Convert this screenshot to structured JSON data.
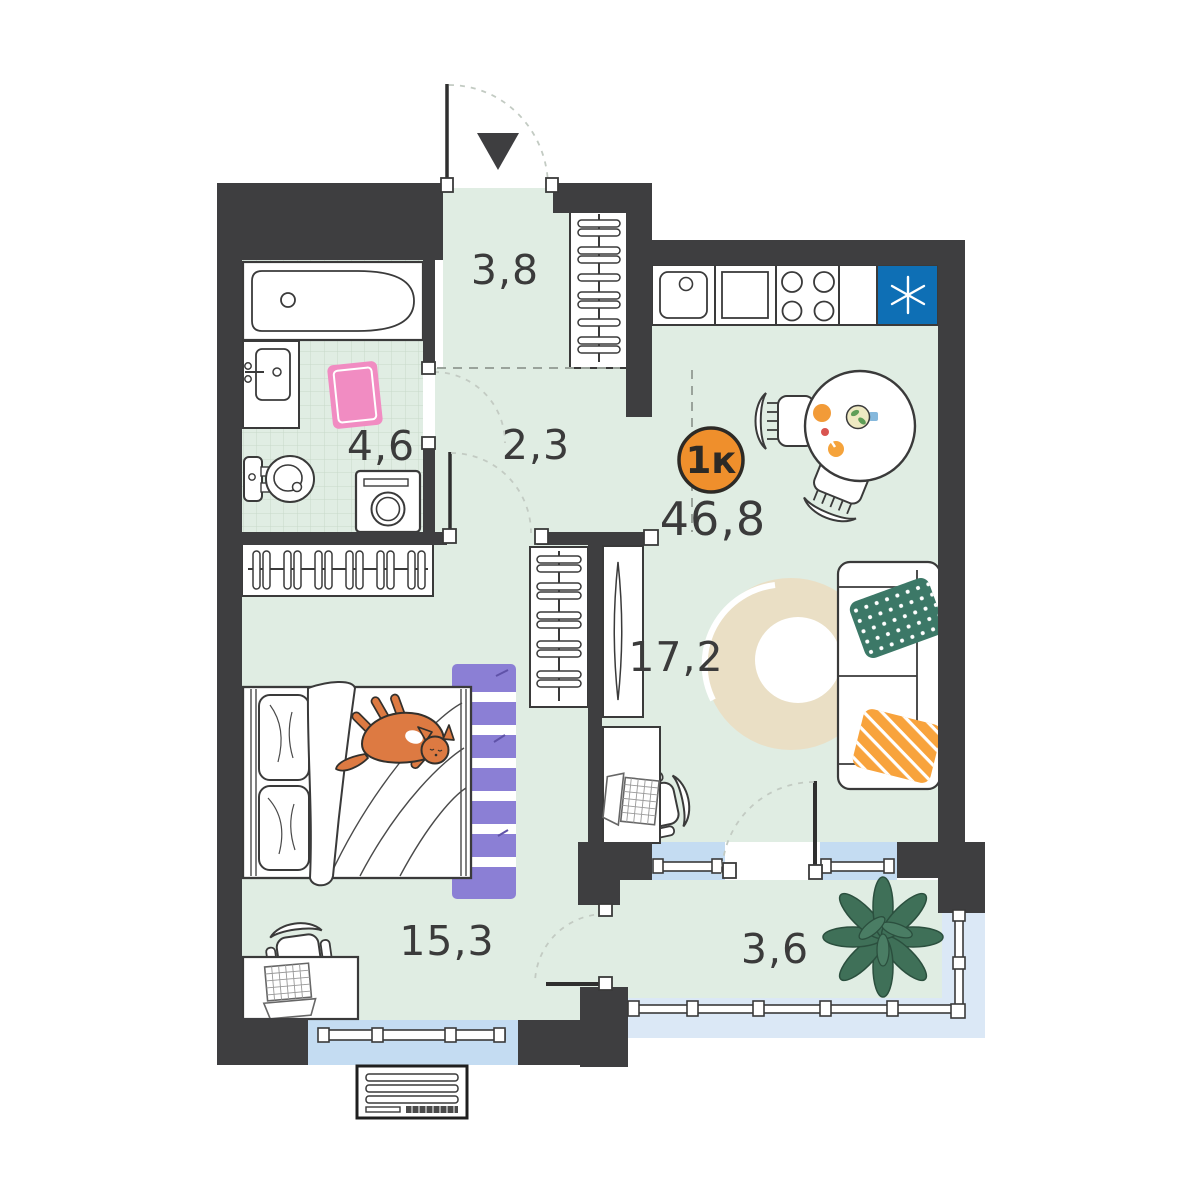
{
  "floorplan": {
    "badge": {
      "label": "1к"
    },
    "total_area": "46,8",
    "rooms": [
      {
        "area": "3,8"
      },
      {
        "area": "4,6"
      },
      {
        "area": "2,3"
      },
      {
        "area": "17,2"
      },
      {
        "area": "15,3"
      },
      {
        "area": "3,6"
      }
    ],
    "colors": {
      "wall": "#3e3e40",
      "floor": "#e0ede3",
      "badge_orange": "#ef8f2c",
      "fridge_blue": "#0e6fb5",
      "window_glass": "#c4dcf2",
      "balcony_glass": "#dbe8f6",
      "rug_purple": "#8b7fd5",
      "rug_beige": "#eadfc5",
      "pillow_green": "#3c7867",
      "pillow_orange": "#f8a33c",
      "cat_orange": "#dd7a42",
      "plant_green": "#3f7058",
      "bathmat_pink": "#f18cc2"
    }
  }
}
